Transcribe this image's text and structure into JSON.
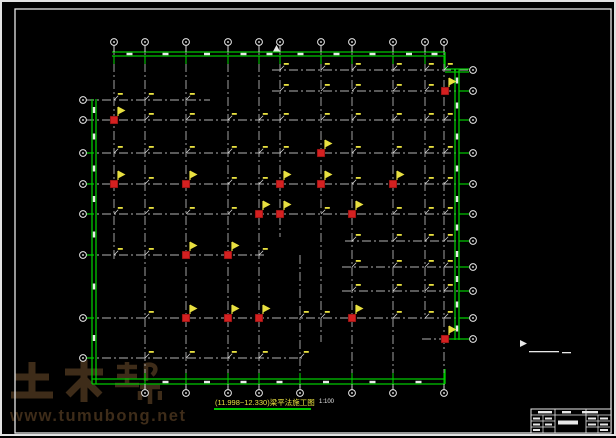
{
  "watermark": {
    "logo_text": "土木帮",
    "url": "www.tumubong.net",
    "color": "#3e2c19"
  },
  "title": {
    "text": "(11.998~12.330)梁平法施工图",
    "scale": "1:100",
    "color": "#e8e040",
    "underline_color": "#00c800"
  },
  "drawing": {
    "colors": {
      "outline": "#00c800",
      "grid": "#b2b2b2",
      "column": "#d42020",
      "column_edge": "#7c1010",
      "flag": "#e8e040",
      "white": "#e8e8e8",
      "frame": "#e8e8e8"
    },
    "axes": {
      "top": {
        "y": 40,
        "xs": [
          112,
          143,
          184,
          226,
          257,
          278,
          319,
          350,
          391,
          423,
          442
        ]
      },
      "bottom": {
        "y": 391,
        "xs": [
          143,
          184,
          226,
          257,
          298,
          350,
          391,
          442
        ]
      },
      "left": {
        "x": 81,
        "ys": [
          98,
          118,
          151,
          182,
          212,
          253,
          316,
          356
        ]
      },
      "right": {
        "x": 471,
        "ys": [
          68,
          89,
          118,
          151,
          182,
          212,
          239,
          265,
          289,
          316,
          337
        ]
      }
    },
    "v_lines": [
      [
        112,
        44,
        258
      ],
      [
        143,
        44,
        387
      ],
      [
        184,
        44,
        387
      ],
      [
        226,
        44,
        387
      ],
      [
        257,
        44,
        387
      ],
      [
        278,
        44,
        235
      ],
      [
        298,
        253,
        387
      ],
      [
        319,
        44,
        340
      ],
      [
        350,
        44,
        387
      ],
      [
        391,
        44,
        387
      ],
      [
        423,
        44,
        317
      ],
      [
        442,
        44,
        387
      ]
    ],
    "h_lines": [
      [
        68,
        270,
        467
      ],
      [
        89,
        270,
        467
      ],
      [
        98,
        83,
        208
      ],
      [
        118,
        83,
        457
      ],
      [
        151,
        83,
        457
      ],
      [
        182,
        83,
        457
      ],
      [
        212,
        83,
        457
      ],
      [
        239,
        343,
        467
      ],
      [
        253,
        83,
        265
      ],
      [
        265,
        340,
        467
      ],
      [
        289,
        340,
        467
      ],
      [
        316,
        83,
        467
      ],
      [
        337,
        420,
        467
      ],
      [
        356,
        83,
        300
      ]
    ],
    "bands": [
      [
        110,
        50,
        443,
        50,
        4
      ],
      [
        90,
        97,
        90,
        382,
        4
      ],
      [
        453,
        67,
        453,
        338,
        4
      ],
      [
        90,
        377,
        443,
        377,
        5
      ],
      [
        443,
        67,
        467,
        67,
        3
      ]
    ],
    "green_singles": [
      [
        443,
        50,
        443,
        67
      ],
      [
        443,
        337,
        467,
        337
      ],
      [
        443,
        367,
        443,
        382
      ],
      [
        457,
        316,
        467,
        316
      ]
    ],
    "left_connector_rows": [
      151,
      182,
      212,
      253,
      316,
      356
    ],
    "right_connector_rows": [
      89,
      118,
      151,
      182,
      212,
      239,
      265,
      289
    ],
    "columns": [
      [
        112,
        118
      ],
      [
        443,
        89
      ],
      [
        319,
        151
      ],
      [
        112,
        182
      ],
      [
        184,
        182
      ],
      [
        278,
        182
      ],
      [
        319,
        182
      ],
      [
        391,
        182
      ],
      [
        257,
        212
      ],
      [
        278,
        212
      ],
      [
        350,
        212
      ],
      [
        184,
        253
      ],
      [
        226,
        253
      ],
      [
        184,
        316
      ],
      [
        226,
        316
      ],
      [
        257,
        316
      ],
      [
        350,
        316
      ],
      [
        443,
        337
      ]
    ],
    "marker_triangle": [
      [
        271,
        49.5
      ],
      [
        274.5,
        43
      ],
      [
        278,
        49.5
      ]
    ],
    "note": {
      "flag_poly": [
        [
          518,
          347
        ],
        [
          518,
          338
        ],
        [
          525,
          341.5
        ],
        [
          518,
          345
        ]
      ],
      "dashes": [
        [
          527,
          349,
          30,
          1.3
        ],
        [
          560,
          350,
          9,
          1.3
        ]
      ]
    }
  },
  "title_block": {
    "x": 529,
    "y": 407,
    "w": 80,
    "h": 24,
    "header_y": 413,
    "v_main": [
      553,
      584
    ],
    "v_sub": [
      [
        541,
        413,
        431
      ],
      [
        596,
        413,
        431
      ]
    ],
    "h_sub": [
      [
        529,
        553,
        419
      ],
      [
        529,
        553,
        425
      ],
      [
        584,
        608,
        419
      ],
      [
        584,
        608,
        425
      ]
    ],
    "blobs": [
      [
        536,
        409,
        14,
        2.4
      ],
      [
        560,
        409,
        9,
        2.4
      ],
      [
        580,
        409,
        16,
        2.4
      ],
      [
        556,
        418.5,
        20,
        4
      ],
      [
        531,
        415.5,
        7,
        2
      ],
      [
        543,
        415.5,
        7,
        2
      ],
      [
        531,
        421.5,
        7,
        2
      ],
      [
        543,
        421.5,
        7,
        2
      ],
      [
        531,
        427,
        7,
        2
      ],
      [
        586,
        415.5,
        8,
        2
      ],
      [
        598,
        415.5,
        8,
        2
      ],
      [
        586,
        421.5,
        8,
        2
      ],
      [
        598,
        421.5,
        8,
        2
      ],
      [
        598,
        427,
        8,
        2
      ]
    ]
  },
  "frame": {
    "inner": [
      13,
      7,
      596,
      424
    ]
  }
}
